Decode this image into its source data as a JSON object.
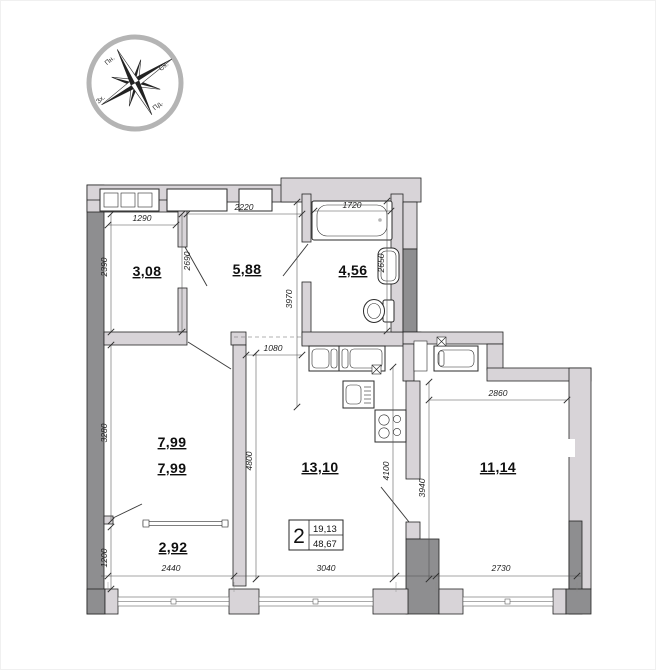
{
  "compass": {
    "labels": {
      "north": "Пн.",
      "east": "Сх.",
      "west": "Зх.",
      "south": "Пд."
    }
  },
  "rooms": [
    {
      "id": "room-1",
      "area": "3,08"
    },
    {
      "id": "room-2",
      "area": "5,88"
    },
    {
      "id": "room-3",
      "area": "4,56"
    },
    {
      "id": "room-4a",
      "area": "7,99"
    },
    {
      "id": "room-4b",
      "area": "7,99"
    },
    {
      "id": "room-5",
      "area": "2,92"
    },
    {
      "id": "room-6",
      "area": "13,10"
    },
    {
      "id": "room-7",
      "area": "11,14"
    }
  ],
  "dims": {
    "d1290": "1290",
    "d2220": "2220",
    "d1720": "1720",
    "d2390": "2390",
    "d2690": "2690",
    "d3970": "3970",
    "d2650": "2650",
    "d3280": "3280",
    "d1080": "1080",
    "d4800": "4800",
    "d4100": "4100",
    "d1200": "1200",
    "d2440": "2440",
    "d3040": "3040",
    "d2730": "2730",
    "d2860": "2860",
    "d3940": "3940"
  },
  "info_box": {
    "rooms_count": "2",
    "area_top": "19,13",
    "area_bottom": "48,67"
  }
}
